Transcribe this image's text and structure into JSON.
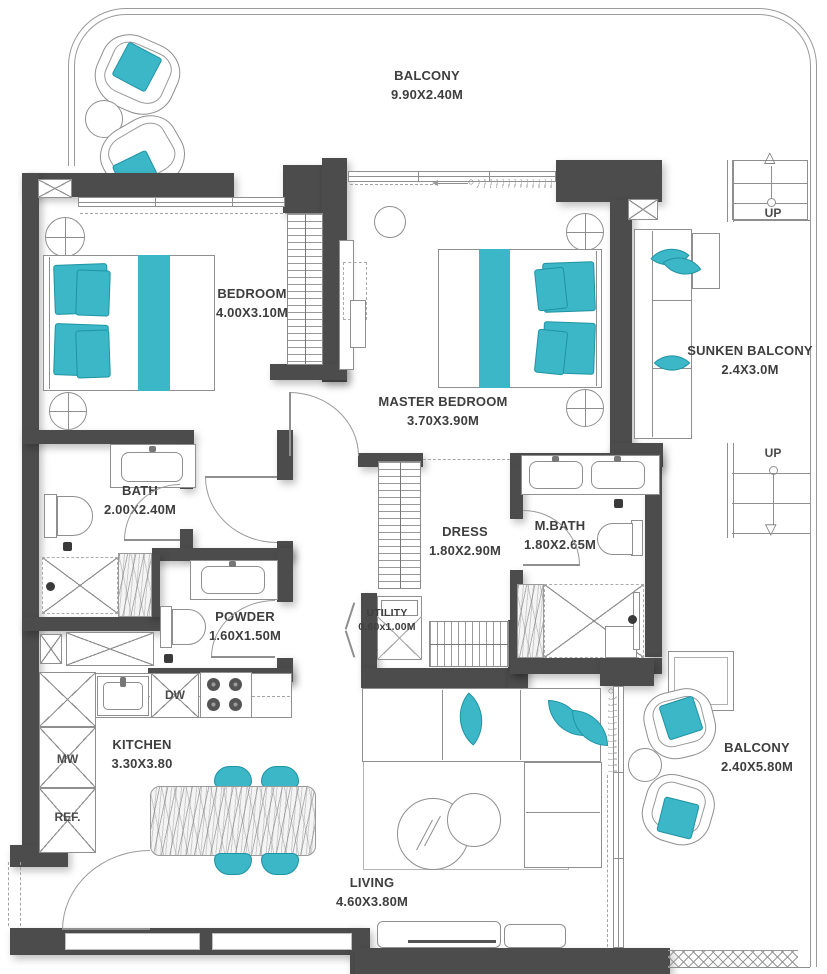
{
  "colors": {
    "accent": "#3BB7C7",
    "wall": "#4C4C4C",
    "line": "#8F8F8F",
    "text": "#3E3E3E"
  },
  "rooms": {
    "balcony_top": {
      "name": "BALCONY",
      "dims": "9.90X2.40M"
    },
    "bedroom": {
      "name": "BEDROOM",
      "dims": "4.00X3.10M"
    },
    "master_bedroom": {
      "name": "MASTER BEDROOM",
      "dims": "3.70X3.90M"
    },
    "sunken_balcony": {
      "name": "SUNKEN BALCONY",
      "dims": "2.4X3.0M"
    },
    "bath": {
      "name": "BATH",
      "dims": "2.00X2.40M"
    },
    "dress": {
      "name": "DRESS",
      "dims": "1.80X2.90M"
    },
    "m_bath": {
      "name": "M.BATH",
      "dims": "1.80X2.65M"
    },
    "powder": {
      "name": "POWDER",
      "dims": "1.60X1.50M"
    },
    "utility": {
      "name": "UTILITY",
      "dims": "0.60x1.00M"
    },
    "kitchen": {
      "name": "KITCHEN",
      "dims": "3.30X3.80"
    },
    "living": {
      "name": "LIVING",
      "dims": "4.60X3.80M"
    },
    "balcony_right": {
      "name": "BALCONY",
      "dims": "2.40X5.80M"
    }
  },
  "appliances": {
    "dishwasher": "DW",
    "microwave": "MW",
    "refrigerator": "REF."
  },
  "stairs": {
    "top": {
      "label": "UP"
    },
    "middle": {
      "label": "UP"
    }
  },
  "icons": {
    "triangle_up": "△",
    "triangle_down": "▽"
  }
}
